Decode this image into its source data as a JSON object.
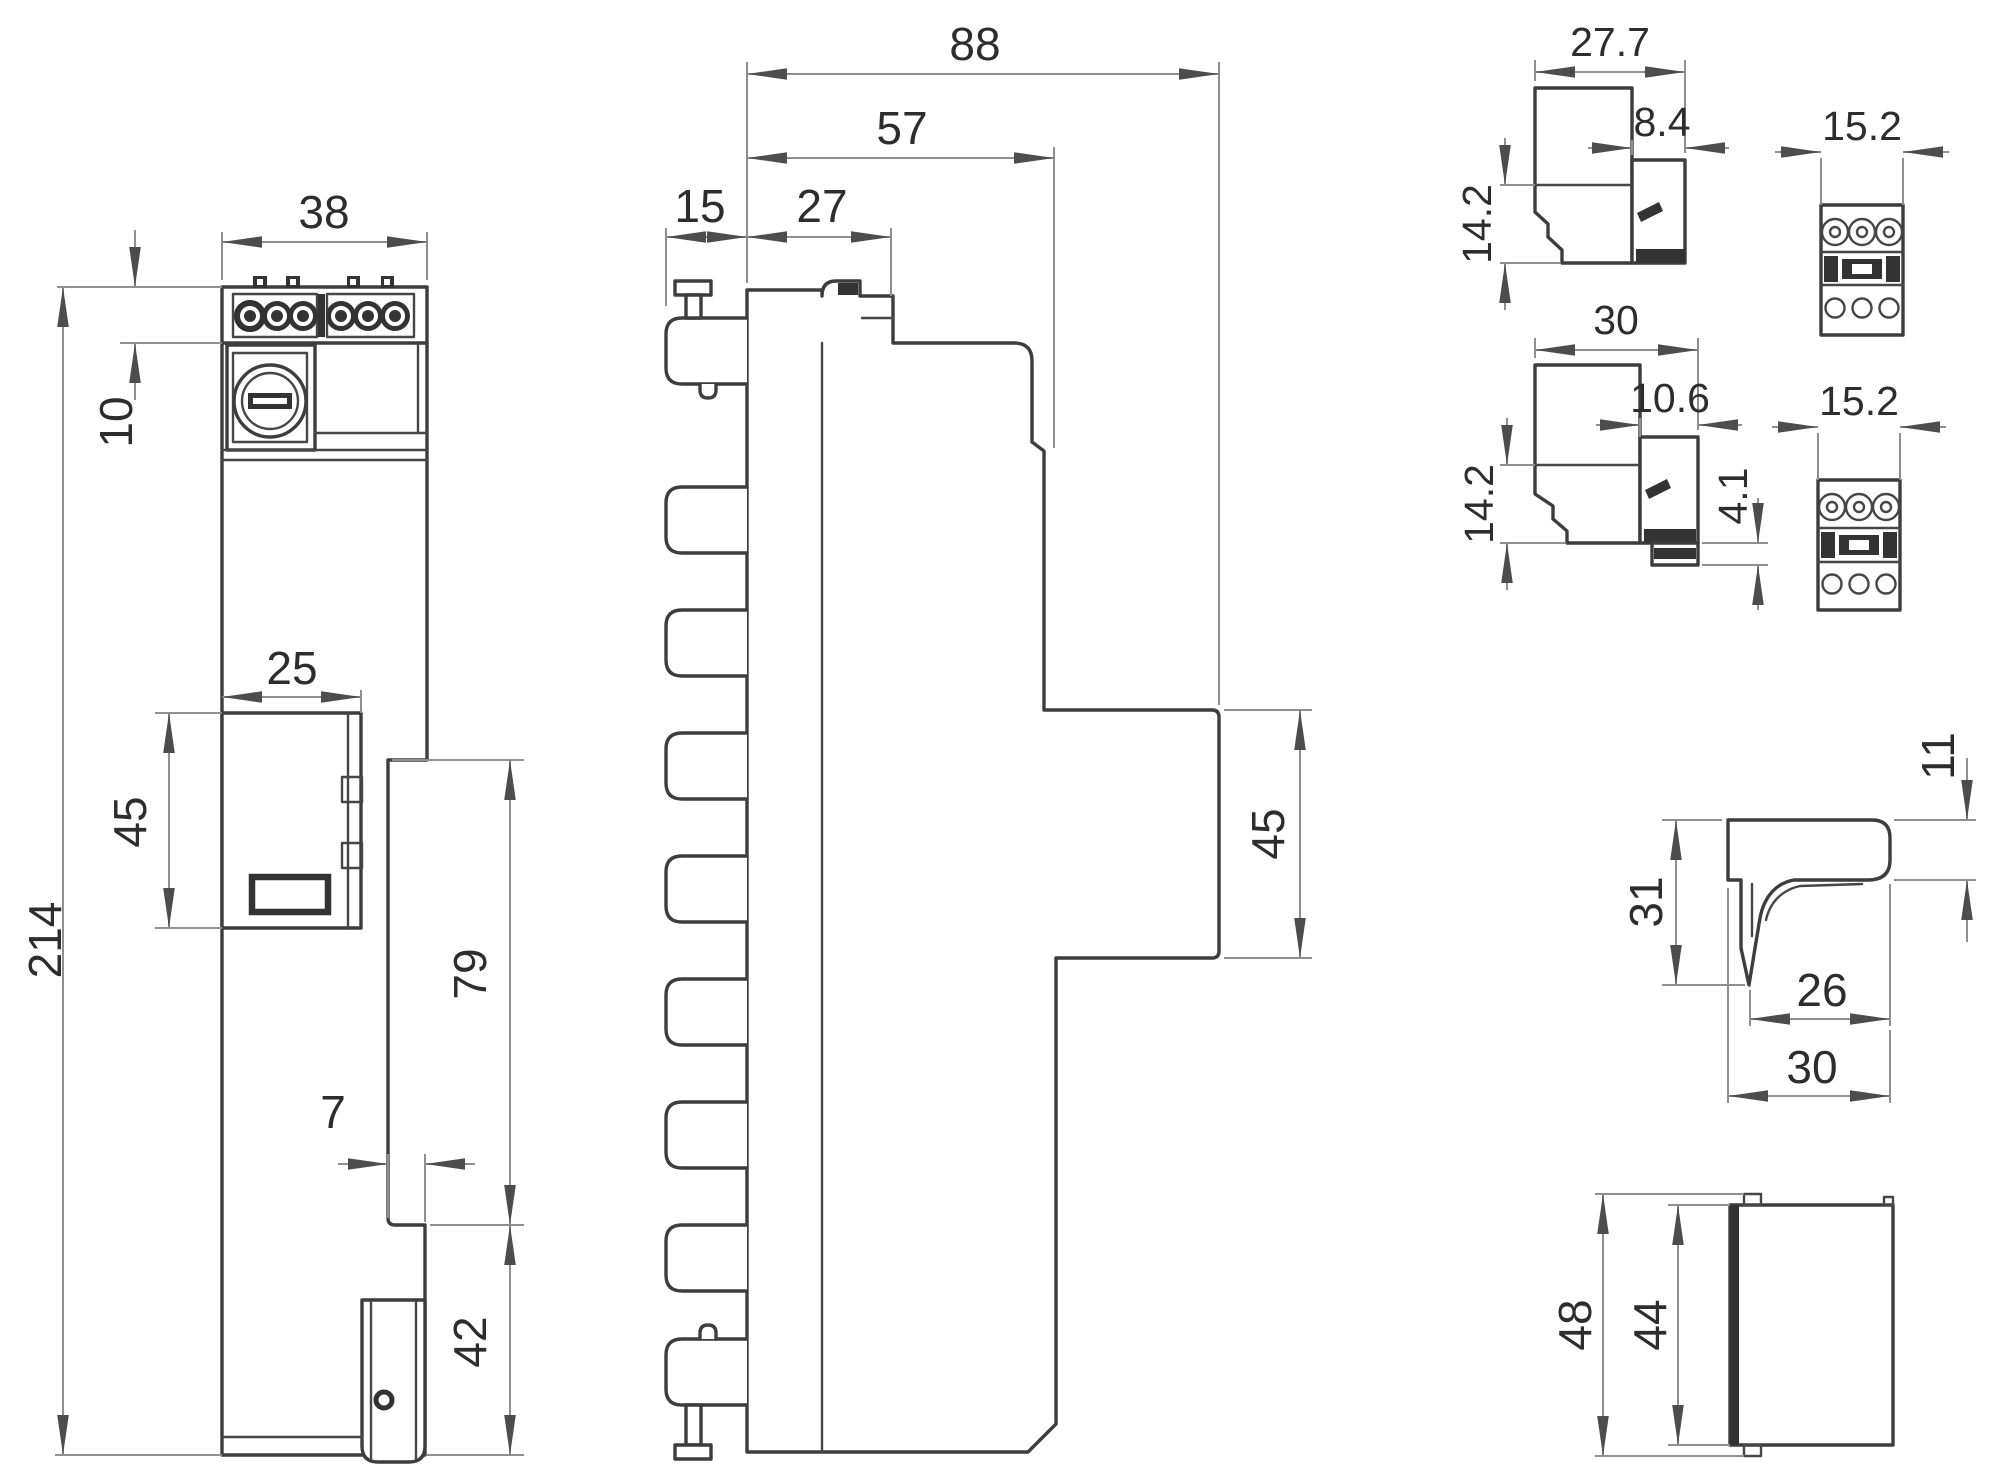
{
  "drawing": {
    "front_view": {
      "overall_width_mm": "38",
      "terminal_block_height_mm": "10",
      "overall_height_mm": "214",
      "module_width_mm": "25",
      "module_height_mm": "45",
      "lower_right_section_mm": "79",
      "step_width_mm": "7",
      "clip_section_height_mm": "42"
    },
    "side_view": {
      "overall_depth_mm": "88",
      "housing_depth_mm": "57",
      "fin_depth_mm": "15",
      "base_column_depth_mm": "27",
      "protrusion_height_mm": "45"
    },
    "connector_detail_top": {
      "width_mm": "27.7",
      "opening_width_mm": "8.4",
      "height_mm": "14.2"
    },
    "terminal_face_top": {
      "width_mm": "15.2"
    },
    "connector_detail_bottom": {
      "width_mm": "30",
      "opening_width_mm": "10.6",
      "latch_height_mm": "4.1",
      "height_mm": "14.2"
    },
    "terminal_face_bottom": {
      "width_mm": "15.2"
    },
    "bracket_view": {
      "flange_thickness_mm": "11",
      "height_mm": "31",
      "inner_width_mm": "26",
      "width_mm": "30"
    },
    "end_plate_view": {
      "outer_height_mm": "48",
      "inner_height_mm": "44"
    }
  }
}
